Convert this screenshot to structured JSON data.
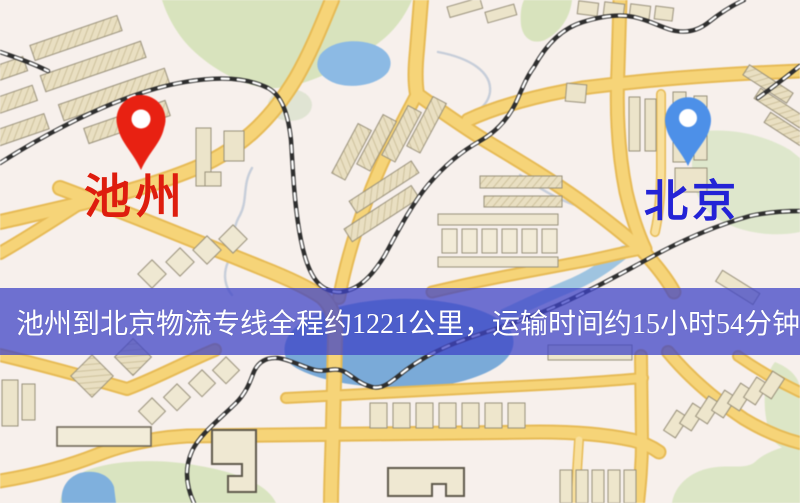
{
  "map": {
    "origin_label": "池州",
    "destination_label": "北京",
    "origin_pin_color": "#e82112",
    "destination_pin_color": "#4d90e8",
    "origin_label_color": "#de1d0e",
    "destination_label_color": "#2323d6",
    "origin_pin_icon": "map-pin",
    "destination_pin_icon": "map-pin"
  },
  "banner": {
    "text": "池州到北京物流专线全程约1221公里，运输时间约15小时54分钟.",
    "background_color": "rgba(62,68,198,0.74)",
    "text_color": "#ffffff"
  }
}
